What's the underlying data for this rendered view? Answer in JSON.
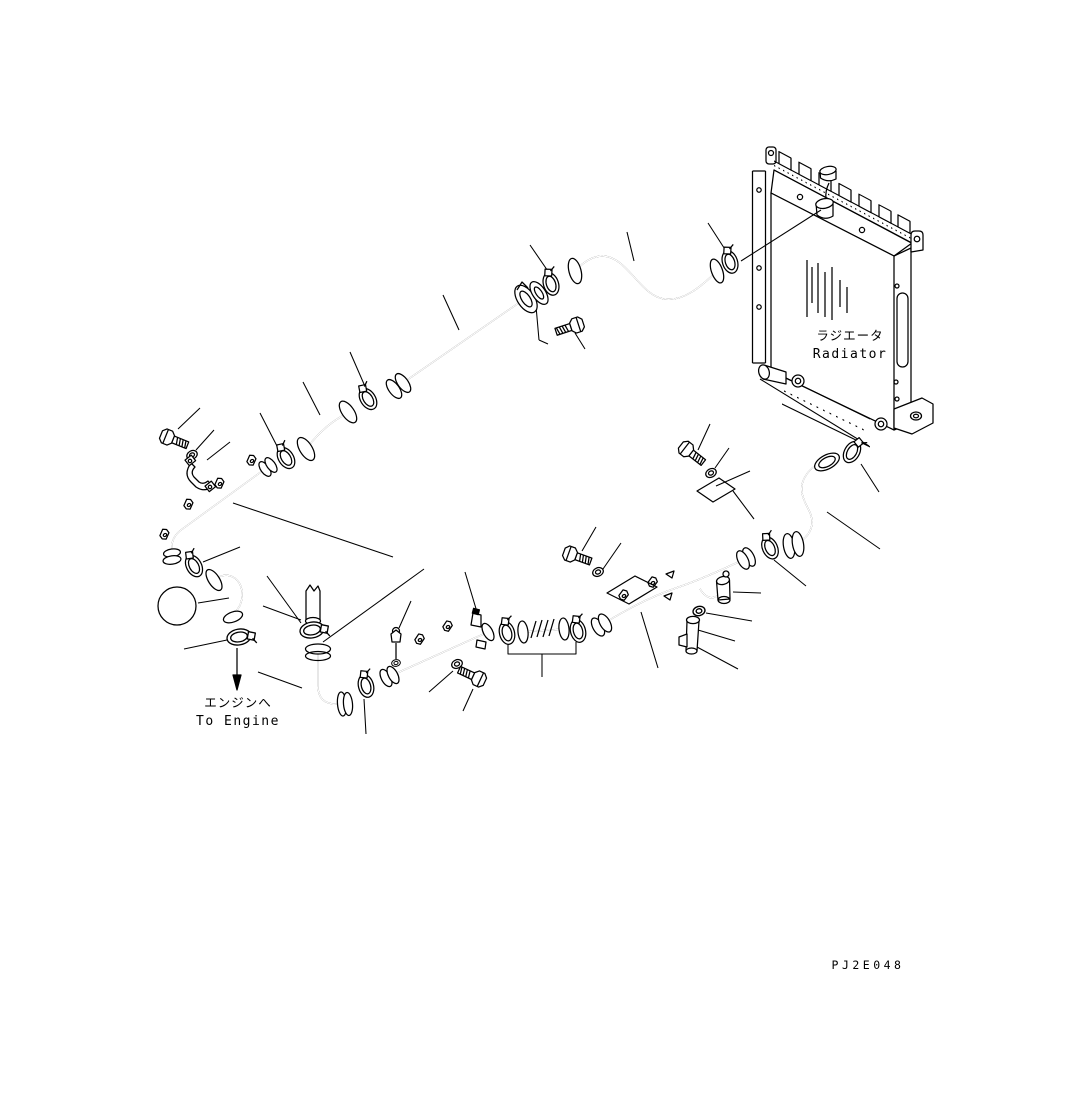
{
  "diagram": {
    "callout": {
      "number": "1",
      "fill": "#1b7e1b"
    },
    "radiator_label": {
      "jp": "ラジエータ",
      "en": "Radiator"
    },
    "to_engine_label": {
      "jp": "エンジンへ",
      "en": "To Engine"
    },
    "drawing_number": "PJ2E048"
  }
}
